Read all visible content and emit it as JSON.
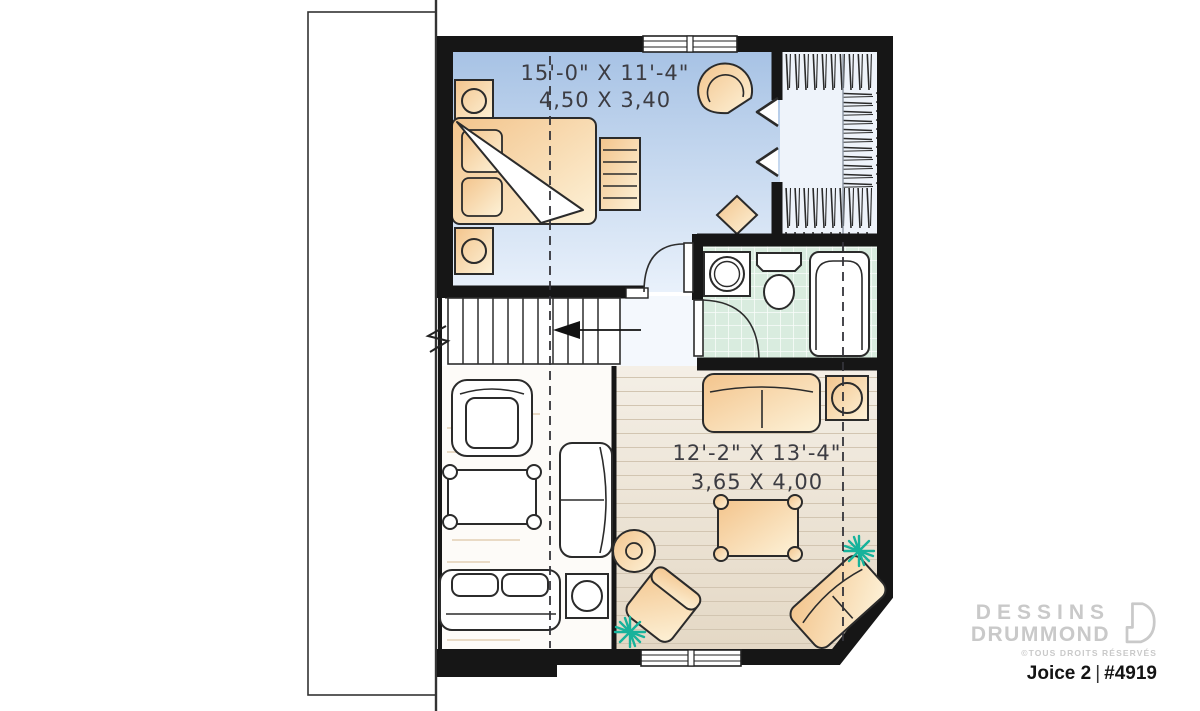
{
  "plan": {
    "brand": {
      "line1": "DESSINS",
      "line2": "DRUMMOND",
      "rights": "©TOUS DROITS RÉSERVÉS"
    },
    "title": {
      "name": "Joice 2",
      "separator": "|",
      "number": "#4919"
    }
  },
  "rooms": {
    "bedroom": {
      "imperial": "15'-0\" X 11'-4\"",
      "metric": "4,50 X 3,40"
    },
    "living_room": {
      "imperial": "12'-2\" X 13'-4\"",
      "metric": "3,65 X 4,00"
    }
  },
  "colors": {
    "wall": "#161616",
    "bedroomFloorTop": "#a5c1e4",
    "bedroomFloorBottom": "#e9f1fb",
    "bathFloor": "#d9ecdf",
    "woodFloorTop": "#f4efe6",
    "woodFloorBottom": "#e4d8c5",
    "furnitureTan": "#f3c48c",
    "furnitureTanLight": "#fdf2d8",
    "plantTeal": "#17b29b",
    "logoGray": "#c9c9c9",
    "titleDark": "#141414",
    "textDark": "#3c3c42"
  }
}
